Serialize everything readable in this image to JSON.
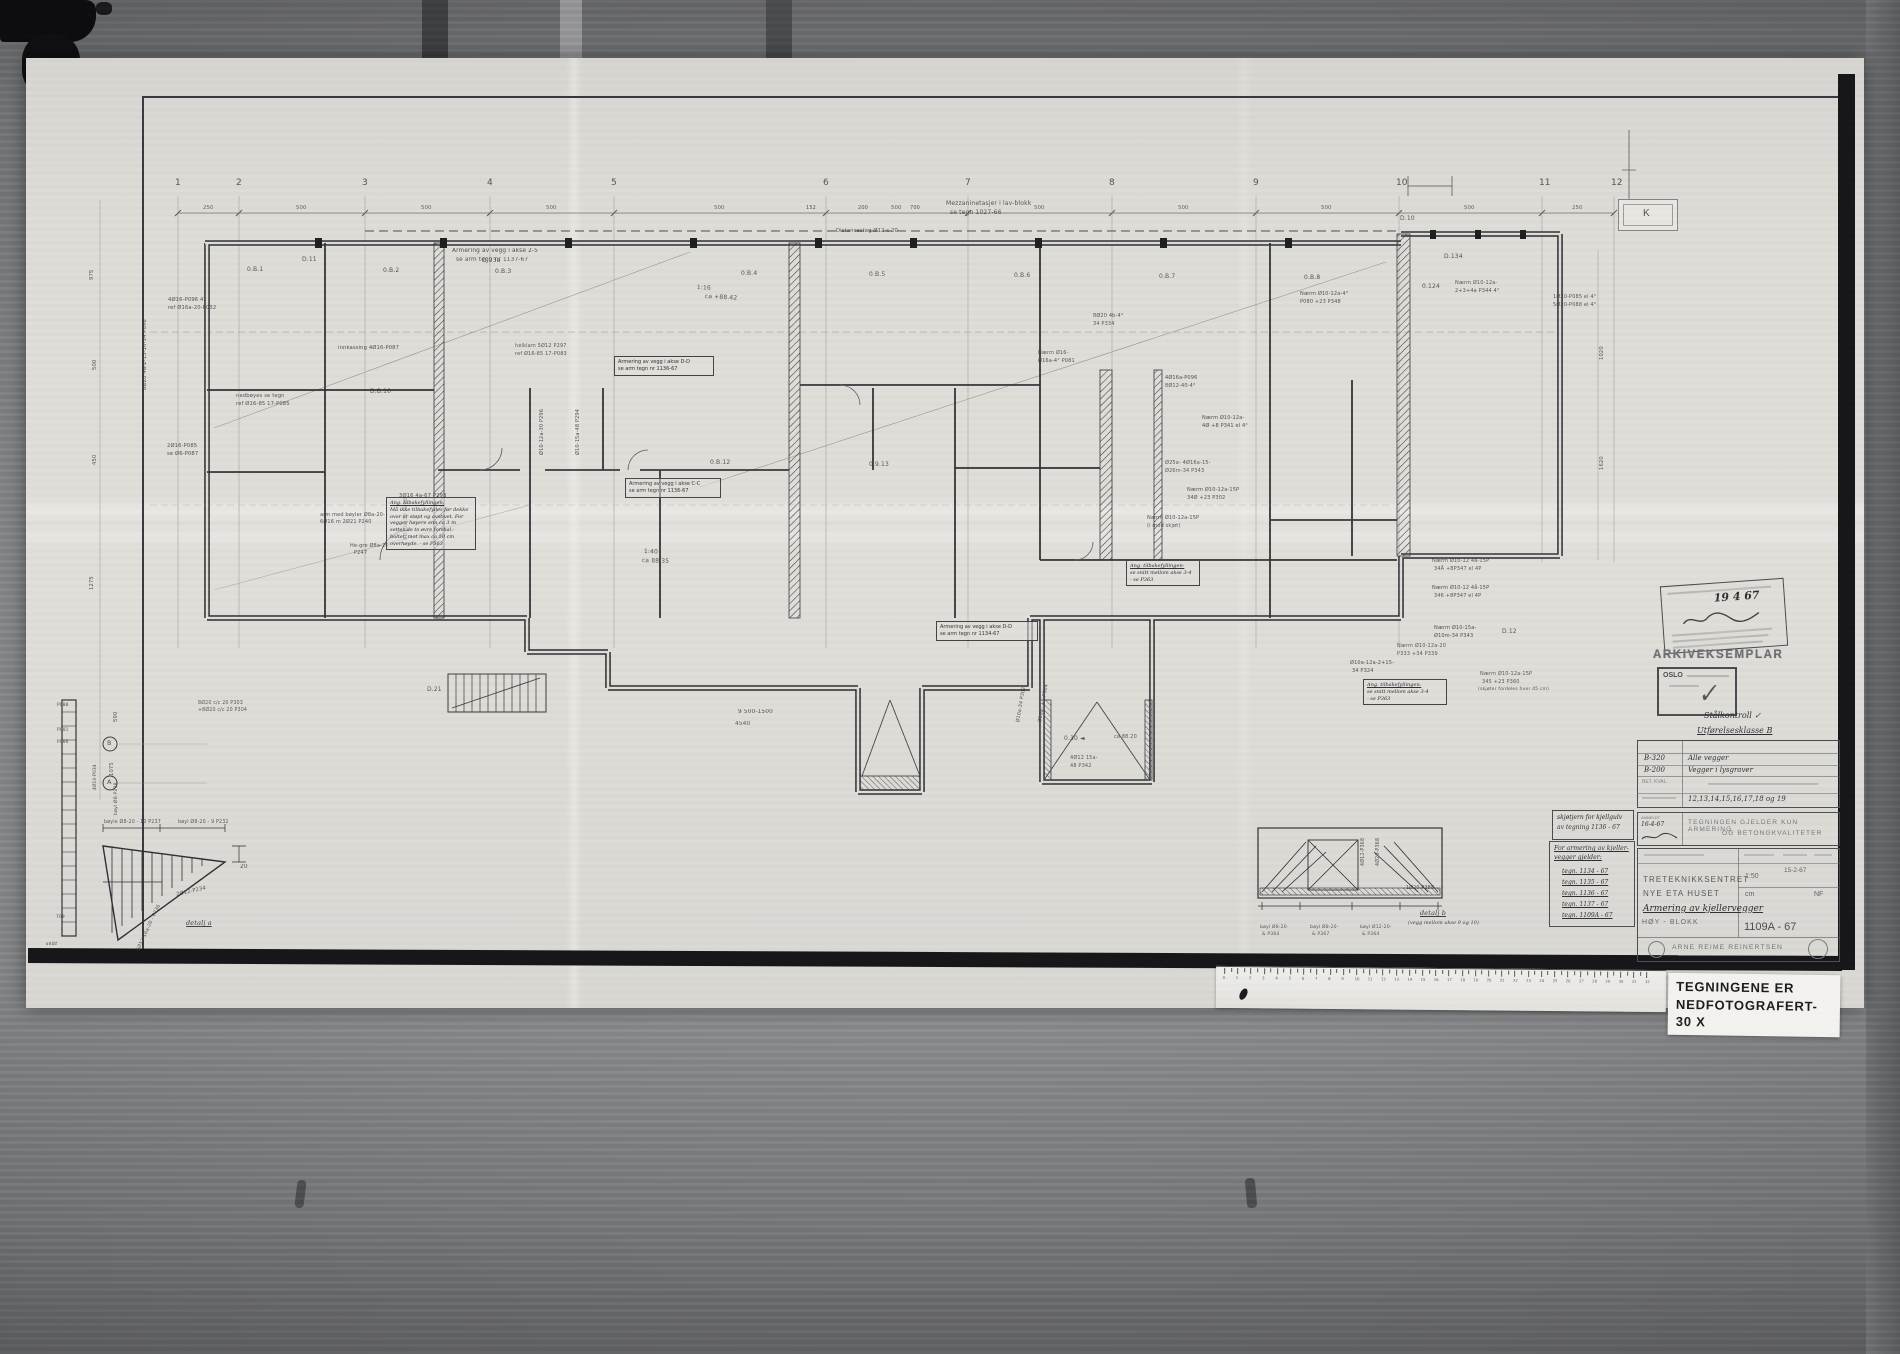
{
  "photo": {
    "label": {
      "line1": "TEGNINGENE ER",
      "line2": "NEDFOTOGRAFERT- 30 X"
    }
  },
  "k_marker": "K",
  "stamps": {
    "arkiv": "ARKIVEKSEMPLAR",
    "oslo": "OSLO",
    "date_hand": "19 4 67",
    "check": "✓",
    "steel_hand": "Stålkontroll ✓",
    "class_hand": "Utførelsesklasse B"
  },
  "title_block": {
    "row1_code": "B-320",
    "row1_val": "Alle vegger",
    "row2_code": "B-200",
    "row2_val": "Vegger i lysgraver",
    "row3_label": "BET. KVAL.",
    "row4_val": "12,13,14,15,16,17,18 og 19",
    "anmeldt_label": "ANMELDT",
    "anmeldt_date": "16-4-67",
    "notice_line1": "TEGNINGEN GJELDER KUN ARMERING",
    "notice_line2": "OG BETONGKVALITETER",
    "firm1": "TRETEKNIKKSENTRET",
    "firm2": "NYE ETA HUSET",
    "subject_hand": "Armering av kjellervegger",
    "block": "HØY - BLOKK",
    "scale": "1:50",
    "unit": "cm",
    "date": "15-2-67",
    "initials": "NF",
    "number": "1109A - 67",
    "company": "ARNE REIME REINERTSEN"
  },
  "side_boxes": {
    "box1_lines": [
      "skjøtjern for kjellgulv",
      "av tegning 1136 - 67"
    ],
    "box2_title": [
      "For armering av kjeller-",
      "vegger gjelder:"
    ],
    "box2_items": [
      "tegn. 1134 - 67",
      "tegn. 1135 - 67",
      "tegn. 1136 - 67",
      "tegn. 1137 - 67",
      "tegn. 1109A - 67"
    ]
  },
  "grid": {
    "columns": [
      {
        "n": "1",
        "x": 178
      },
      {
        "n": "2",
        "x": 239
      },
      {
        "n": "3",
        "x": 365
      },
      {
        "n": "4",
        "x": 490
      },
      {
        "n": "5",
        "x": 614
      },
      {
        "n": "6",
        "x": 826
      },
      {
        "n": "7",
        "x": 968
      },
      {
        "n": "8",
        "x": 1112
      },
      {
        "n": "9",
        "x": 1256
      },
      {
        "n": "10",
        "x": 1399
      },
      {
        "n": "11",
        "x": 1542
      },
      {
        "n": "12",
        "x": 1614
      }
    ],
    "top_dims": [
      {
        "t": "250",
        "x": 203
      },
      {
        "t": "500",
        "x": 296
      },
      {
        "t": "500",
        "x": 421
      },
      {
        "t": "500",
        "x": 546
      },
      {
        "t": "500",
        "x": 714
      },
      {
        "t": "500",
        "x": 891
      },
      {
        "t": "500",
        "x": 1034
      },
      {
        "t": "500",
        "x": 1178
      },
      {
        "t": "500",
        "x": 1321
      },
      {
        "t": "500",
        "x": 1464
      },
      {
        "t": "250",
        "x": 1572
      }
    ]
  },
  "ruler": {
    "numbers": [
      "0",
      "1",
      "2",
      "3",
      "4",
      "5",
      "6",
      "7",
      "8",
      "9",
      "10",
      "11",
      "12",
      "13",
      "14",
      "15",
      "16",
      "17",
      "18",
      "19",
      "20",
      "21",
      "22",
      "23",
      "24",
      "25",
      "26",
      "27",
      "28",
      "29",
      "30",
      "31",
      "32"
    ]
  },
  "boxed_notes": [
    {
      "x": 614,
      "y": 356,
      "w": 92,
      "lines": [
        "Armering av vegg i akse D-D",
        "se arm tegn nr 1136-67"
      ]
    },
    {
      "x": 625,
      "y": 478,
      "w": 88,
      "lines": [
        "Armering av vegg i akse C-C",
        "se arm tegn nr 1136-67"
      ]
    },
    {
      "x": 936,
      "y": 621,
      "w": 94,
      "lines": [
        "Armering av vegg i akse D-D",
        "se arm tegn nr 1134-67"
      ]
    },
    {
      "x": 1126,
      "y": 560,
      "w": 66,
      "hand": true,
      "lines": [
        "Ang. tilbakefyllingen-",
        "se snitt mellom akse 3-4",
        "- se P363"
      ]
    },
    {
      "x": 1363,
      "y": 679,
      "w": 76,
      "hand": true,
      "lines": [
        "Ang. tilbakefyllingen.",
        "se snitt mellom akse 3-4",
        "- se P363"
      ]
    },
    {
      "x": 386,
      "y": 497,
      "w": 82,
      "hand": true,
      "lines": [
        "Ang. tilbakefyllingen.",
        "Må ikke tilbakefylles før dekke",
        "over er støpt og avstivet. For",
        "vegger høyere enn ca 3 m",
        "settes de to øvre forskal.-",
        "bolter, mot max ca 50 cm",
        "overhøyde. - se P363"
      ]
    }
  ],
  "annotations": [
    {
      "x": 946,
      "y": 201,
      "t": "Mezzaninetasjer i lav-blokk"
    },
    {
      "x": 950,
      "y": 210,
      "t": "se tegn 1027-66"
    },
    {
      "x": 836,
      "y": 229,
      "t": "Distansestag Ø12 c 20",
      "fs": 5.2
    },
    {
      "x": 806,
      "y": 206,
      "t": "152",
      "fs": 5
    },
    {
      "x": 858,
      "y": 206,
      "t": "200",
      "fs": 5
    },
    {
      "x": 910,
      "y": 206,
      "t": "700",
      "fs": 5
    },
    {
      "x": 247,
      "y": 267,
      "t": "0.B.1"
    },
    {
      "x": 383,
      "y": 268,
      "t": "0.B.2"
    },
    {
      "x": 495,
      "y": 269,
      "t": "0.B.3"
    },
    {
      "x": 741,
      "y": 271,
      "t": "0.B.4"
    },
    {
      "x": 869,
      "y": 272,
      "t": "0.B.5"
    },
    {
      "x": 1014,
      "y": 273,
      "t": "0.B.6"
    },
    {
      "x": 1159,
      "y": 274,
      "t": "0.B.7"
    },
    {
      "x": 1304,
      "y": 275,
      "t": "0.B.8"
    },
    {
      "x": 302,
      "y": 257,
      "t": "D.11"
    },
    {
      "x": 482,
      "y": 258,
      "t": "D.23a"
    },
    {
      "x": 1400,
      "y": 216,
      "t": "D.10"
    },
    {
      "x": 1444,
      "y": 254,
      "t": "D.134"
    },
    {
      "x": 1422,
      "y": 284,
      "t": "0.124"
    },
    {
      "x": 370,
      "y": 389,
      "t": "D.B.10"
    },
    {
      "x": 710,
      "y": 460,
      "t": "0.B.12"
    },
    {
      "x": 869,
      "y": 462,
      "t": "0.9.13"
    },
    {
      "x": 1502,
      "y": 629,
      "t": "D.12"
    },
    {
      "x": 427,
      "y": 687,
      "t": "D.21"
    },
    {
      "x": 1064,
      "y": 736,
      "t": "0.30 ◄"
    },
    {
      "x": 168,
      "y": 298,
      "t": "4Ø16-P096 4°",
      "fs": 5.2
    },
    {
      "x": 168,
      "y": 306,
      "t": "ref Ø16a-20-P032",
      "fs": 5.2
    },
    {
      "x": 143,
      "y": 390,
      "t": "8Ø20 4a-2-15-16-14 P098",
      "r": -90,
      "fs": 5.2
    },
    {
      "x": 167,
      "y": 444,
      "t": "2Ø16-P085",
      "fs": 5.2
    },
    {
      "x": 167,
      "y": 452,
      "t": "se Ø6-P087",
      "fs": 5.2
    },
    {
      "x": 236,
      "y": 394,
      "t": "nedbøyes se tegn",
      "fs": 5.2
    },
    {
      "x": 236,
      "y": 402,
      "t": "ref Ø16-85 17-P085",
      "fs": 5.2
    },
    {
      "x": 338,
      "y": 346,
      "t": "innkassing 4Ø16-P087",
      "fs": 5.2
    },
    {
      "x": 452,
      "y": 248,
      "t": "Armering av vegg i akse 2-5",
      "fs": 5.8
    },
    {
      "x": 456,
      "y": 257,
      "t": "se arm tegn nr 1137-67",
      "fs": 5.8
    },
    {
      "x": 697,
      "y": 285,
      "t": "1:16",
      "r": 3
    },
    {
      "x": 705,
      "y": 294,
      "t": "ca +88.42",
      "r": 3
    },
    {
      "x": 644,
      "y": 549,
      "t": "1:40",
      "r": 2
    },
    {
      "x": 642,
      "y": 558,
      "t": "ca 88.35",
      "r": 2
    },
    {
      "x": 399,
      "y": 494,
      "t": "3Ø16 4a-67 P293",
      "fs": 5.2
    },
    {
      "x": 404,
      "y": 540,
      "t": "8Ø10a-30 P298",
      "r": -90,
      "fs": 5.2
    },
    {
      "x": 320,
      "y": 513,
      "t": "arm med bøyler Ø8a-20-",
      "fs": 5
    },
    {
      "x": 320,
      "y": 520,
      "t": "6Ø16 m 2Ø21 P240",
      "fs": 5
    },
    {
      "x": 350,
      "y": 544,
      "t": "He-gre Ø8a-20",
      "fs": 5
    },
    {
      "x": 354,
      "y": 551,
      "t": "P247",
      "fs": 5
    },
    {
      "x": 540,
      "y": 455,
      "t": "Ø10-12a-30 P296",
      "r": -90,
      "fs": 5
    },
    {
      "x": 576,
      "y": 455,
      "t": "Ø10-15a-48 P294",
      "r": -90,
      "fs": 5
    },
    {
      "x": 515,
      "y": 344,
      "t": "helklam 5Ø12 P297",
      "fs": 5
    },
    {
      "x": 515,
      "y": 352,
      "t": "ref Ø16-85 17-P083",
      "fs": 5
    },
    {
      "x": 1093,
      "y": 314,
      "t": "8Ø20 4b-4°",
      "fs": 5
    },
    {
      "x": 1093,
      "y": 322,
      "t": "34 P334",
      "fs": 5
    },
    {
      "x": 1038,
      "y": 351,
      "t": "Nærm Ø16-",
      "fs": 5
    },
    {
      "x": 1038,
      "y": 359,
      "t": "Ø16a-4° P081",
      "fs": 5
    },
    {
      "x": 1300,
      "y": 292,
      "t": "Nærm Ø10-12a-4°",
      "fs": 5
    },
    {
      "x": 1300,
      "y": 300,
      "t": "P080 +23 P348",
      "fs": 5
    },
    {
      "x": 1455,
      "y": 281,
      "t": "Nærm Ø10-12a-",
      "fs": 5
    },
    {
      "x": 1455,
      "y": 289,
      "t": "2+3+4a P344 4°",
      "fs": 5
    },
    {
      "x": 1553,
      "y": 295,
      "t": "1Ø20-P085 el 4°",
      "fs": 5
    },
    {
      "x": 1553,
      "y": 303,
      "t": "5Ø20-P088 el 4°",
      "fs": 5
    },
    {
      "x": 1432,
      "y": 559,
      "t": "Nærm Ø10-12 4å-15P",
      "fs": 5
    },
    {
      "x": 1434,
      "y": 567,
      "t": "34Å +8P347 el 4P",
      "fs": 5
    },
    {
      "x": 1432,
      "y": 586,
      "t": "Nærm Ø10-12 4å-15P",
      "fs": 5
    },
    {
      "x": 1434,
      "y": 594,
      "t": "346 +8P347 el 4P",
      "fs": 5
    },
    {
      "x": 1434,
      "y": 626,
      "t": "Nærm Ø10-15a-",
      "fs": 5
    },
    {
      "x": 1434,
      "y": 634,
      "t": "Ø10m-34 P343",
      "fs": 5
    },
    {
      "x": 1397,
      "y": 644,
      "t": "Nærm Ø10-12a-20",
      "fs": 5
    },
    {
      "x": 1397,
      "y": 652,
      "t": "P333 +34 P339",
      "fs": 5
    },
    {
      "x": 1350,
      "y": 661,
      "t": "Ø10a-12a-2+15-",
      "fs": 5
    },
    {
      "x": 1352,
      "y": 669,
      "t": "34 P324",
      "fs": 5
    },
    {
      "x": 1480,
      "y": 672,
      "t": "Nærm Ø10-12a-15P",
      "fs": 5
    },
    {
      "x": 1482,
      "y": 680,
      "t": "345 +23 P360",
      "fs": 5
    },
    {
      "x": 1478,
      "y": 688,
      "t": "(skjøter fordeles hver 45 cm)",
      "fs": 4.6
    },
    {
      "x": 1165,
      "y": 376,
      "t": "4Ø16a-P096",
      "fs": 5
    },
    {
      "x": 1165,
      "y": 384,
      "t": "8Ø12-40-4°",
      "fs": 5
    },
    {
      "x": 1202,
      "y": 416,
      "t": "Nærm Ø10-12a-",
      "fs": 5
    },
    {
      "x": 1202,
      "y": 424,
      "t": "4Ø +8 P341 el 4°",
      "fs": 5
    },
    {
      "x": 1165,
      "y": 461,
      "t": "Ø25a- 4Ø16a-15-",
      "fs": 5
    },
    {
      "x": 1165,
      "y": 469,
      "t": "Ø26m-34 P343",
      "fs": 5
    },
    {
      "x": 1187,
      "y": 488,
      "t": "Nærm Ø10-12a-15P",
      "fs": 5
    },
    {
      "x": 1187,
      "y": 496,
      "t": "34Ø +23 P302",
      "fs": 5
    },
    {
      "x": 1147,
      "y": 516,
      "t": "Nærm Ø10-12a-15P",
      "fs": 5
    },
    {
      "x": 1147,
      "y": 524,
      "t": "(i mod skjøt)",
      "fs": 5
    },
    {
      "x": 1070,
      "y": 756,
      "t": "4Ø12 15a-",
      "fs": 5
    },
    {
      "x": 1070,
      "y": 764,
      "t": "48 P342",
      "fs": 5
    },
    {
      "x": 1114,
      "y": 735,
      "t": "ca 88.20",
      "fs": 5
    },
    {
      "x": 1016,
      "y": 722,
      "t": "Ø10a-34 P302",
      "r": -80,
      "fs": 4.8
    },
    {
      "x": 1038,
      "y": 722,
      "t": "Ø10a- +5 P304",
      "r": -80,
      "fs": 4.8
    },
    {
      "x": 738,
      "y": 709,
      "t": "9 500-1500",
      "fs": 5.8
    },
    {
      "x": 735,
      "y": 721,
      "t": "4540",
      "fs": 5.8
    },
    {
      "x": 1600,
      "y": 360,
      "t": "1020",
      "r": -90,
      "fs": 5.2
    },
    {
      "x": 1600,
      "y": 470,
      "t": "1620",
      "r": -90,
      "fs": 5.2
    },
    {
      "x": 90,
      "y": 280,
      "t": "975",
      "r": -90,
      "fs": 5.2
    },
    {
      "x": 93,
      "y": 370,
      "t": "500",
      "r": -90,
      "fs": 5.2
    },
    {
      "x": 93,
      "y": 465,
      "t": "450",
      "r": -90,
      "fs": 5.2
    },
    {
      "x": 90,
      "y": 590,
      "t": "1275",
      "r": -90,
      "fs": 5.2
    },
    {
      "x": 114,
      "y": 722,
      "t": "590",
      "r": -90,
      "fs": 5.2
    },
    {
      "x": 110,
      "y": 776,
      "t": "1075",
      "r": -90,
      "fs": 5.2
    },
    {
      "x": 107,
      "y": 740,
      "t": "B",
      "fs": 6.5
    },
    {
      "x": 107,
      "y": 779,
      "t": "A",
      "fs": 6.5
    },
    {
      "x": 104,
      "y": 820,
      "t": "bøyle Ø8-20 - 10 P237",
      "fs": 4.8
    },
    {
      "x": 178,
      "y": 820,
      "t": "bøyl Ø8-20 - 9 P232",
      "fs": 4.8
    },
    {
      "x": 176,
      "y": 893,
      "t": "2Ø12-P234",
      "r": -13,
      "fs": 5.2
    },
    {
      "x": 186,
      "y": 920,
      "t": "detalj a",
      "fs": 6.5,
      "s": "h",
      "u": true
    },
    {
      "x": 240,
      "y": 864,
      "t": "20",
      "fs": 5.8
    },
    {
      "x": 136,
      "y": 950,
      "t": "6Ø12 16a-20 - P236",
      "r": -65,
      "fs": 4.8
    },
    {
      "x": 115,
      "y": 815,
      "t": "bøyl Ø8-P238",
      "r": -90,
      "fs": 4.6
    },
    {
      "x": 198,
      "y": 701,
      "t": "8Ø20 c/c 20 P303",
      "fs": 4.8
    },
    {
      "x": 198,
      "y": 708,
      "t": "+8Ø20 c/c 20 P304",
      "fs": 4.8
    },
    {
      "x": 57,
      "y": 704,
      "t": "P088",
      "fs": 4.4
    },
    {
      "x": 57,
      "y": 729,
      "t": "P081",
      "fs": 4.4
    },
    {
      "x": 57,
      "y": 741,
      "t": "P086",
      "fs": 4.4
    },
    {
      "x": 94,
      "y": 790,
      "t": "4Ø10-P034",
      "r": -90,
      "fs": 4.4
    },
    {
      "x": 56,
      "y": 916,
      "t": "709",
      "fs": 4.4
    },
    {
      "x": 46,
      "y": 943,
      "t": "snitt",
      "fs": 4.6,
      "s": "h"
    },
    {
      "x": 1361,
      "y": 866,
      "t": "4Ø12-P368",
      "r": -90,
      "fs": 4.8
    },
    {
      "x": 1376,
      "y": 866,
      "t": "4Ø20-P368",
      "r": -90,
      "fs": 4.8
    },
    {
      "x": 1406,
      "y": 886,
      "t": "1Ø20-P388",
      "fs": 4.8
    },
    {
      "x": 1420,
      "y": 910,
      "t": "detalj b",
      "fs": 6.5,
      "s": "h",
      "u": true
    },
    {
      "x": 1408,
      "y": 921,
      "t": "(vegg mellom akse 9 og 10)",
      "fs": 4.8,
      "s": "h"
    },
    {
      "x": 1260,
      "y": 926,
      "t": "bøyl Ø8-20-",
      "fs": 4.6
    },
    {
      "x": 1262,
      "y": 933,
      "t": "& P364",
      "fs": 4.6
    },
    {
      "x": 1310,
      "y": 926,
      "t": "bøyl Ø8-20-",
      "fs": 4.6
    },
    {
      "x": 1312,
      "y": 933,
      "t": "& P367",
      "fs": 4.6
    },
    {
      "x": 1360,
      "y": 926,
      "t": "bøyl Ø12-20-",
      "fs": 4.6
    },
    {
      "x": 1362,
      "y": 933,
      "t": "& P364",
      "fs": 4.6
    }
  ]
}
